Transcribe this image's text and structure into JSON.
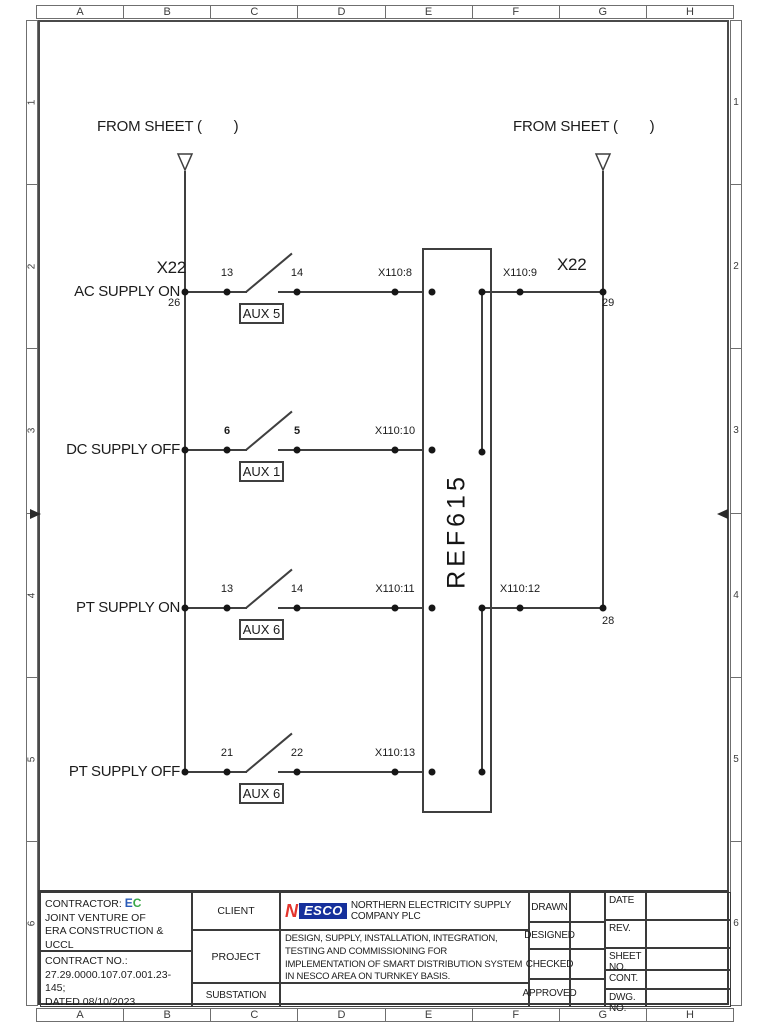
{
  "frame": {
    "columns": [
      "A",
      "B",
      "C",
      "D",
      "E",
      "F",
      "G",
      "H"
    ],
    "rows": [
      "1",
      "2",
      "3",
      "4",
      "5",
      "6"
    ]
  },
  "diagram": {
    "from_sheet_left": "FROM SHEET (        )",
    "from_sheet_right": "FROM SHEET (        )",
    "relay": "REF615",
    "terminal_left": {
      "name": "X22",
      "pin": "26"
    },
    "terminal_right_top": {
      "name": "X22",
      "pin": "29"
    },
    "terminal_right_bottom_pin": "28",
    "rows": [
      {
        "label": "AC SUPPLY ON",
        "pin_a": "13",
        "pin_b": "14",
        "aux": "AUX 5",
        "wire": "X110:8",
        "wire_out": "X110:9"
      },
      {
        "label": "DC SUPPLY OFF",
        "pin_a": "6",
        "pin_b": "5",
        "aux": "AUX 1",
        "wire": "X110:10"
      },
      {
        "label": "PT SUPPLY ON",
        "pin_a": "13",
        "pin_b": "14",
        "aux": "AUX 6",
        "wire": "X110:11",
        "wire_out": "X110:12"
      },
      {
        "label": "PT SUPPLY OFF",
        "pin_a": "21",
        "pin_b": "22",
        "aux": "AUX 6",
        "wire": "X110:13"
      }
    ]
  },
  "title_block": {
    "contractor": {
      "label": "CONTRACTOR:",
      "logo_e": "E",
      "logo_c": "C",
      "line2": "JOINT VENTURE OF",
      "line3": "ERA CONSTRUCTION & UCCL",
      "contract_label": "CONTRACT NO.:",
      "contract_no": "27.29.0000.107.07.001.23-145;",
      "dated": "DATED 08/10/2023"
    },
    "row_labels": {
      "client": "CLIENT",
      "project": "PROJECT",
      "substation": "SUBSTATION"
    },
    "client": {
      "logo_n": "N",
      "logo_esco": "ESCO",
      "name": "NORTHERN ELECTRICITY SUPPLY COMPANY PLC"
    },
    "project_description": "DESIGN, SUPPLY, INSTALLATION, INTEGRATION, TESTING AND COMMISSIONING FOR IMPLEMENTATION OF SMART DISTRIBUTION SYSTEM IN NESCO AREA ON TURNKEY BASIS.",
    "signoff": [
      "DRAWN",
      "DESIGNED",
      "CHECKED",
      "APPROVED"
    ],
    "meta": [
      "DATE",
      "REV.",
      "SHEET NO.",
      "CONT.",
      "DWG. NO."
    ],
    "colors": {
      "nesco_blue": "#16309c",
      "nesco_red": "#e3342c",
      "ec_blue": "#2a5bb8",
      "ec_green": "#3aa848"
    }
  }
}
